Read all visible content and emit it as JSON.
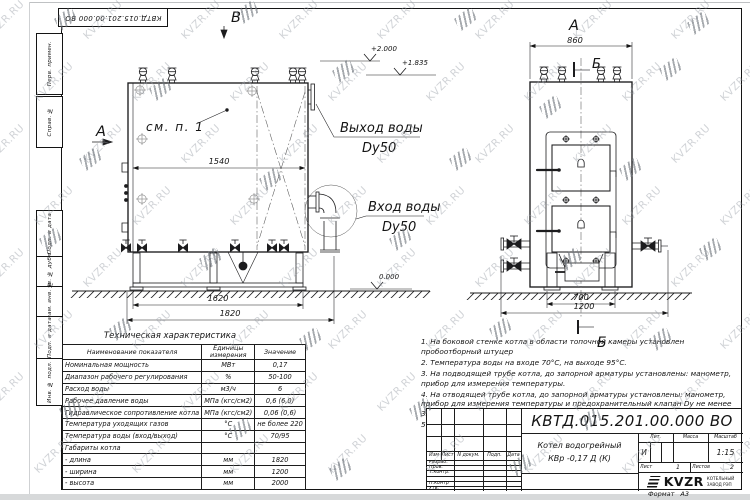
{
  "watermark": {
    "text": "KVZR.RU"
  },
  "stamp_top": {
    "text": "КВТД.015.201.00.000  ВО"
  },
  "side_column": {
    "box1": "Перв. примен.",
    "box2": "Справ. №",
    "box3": "Подп. и дата",
    "box4": "Инв. № дубл.",
    "box5": "Взам. инв. №",
    "box6": "Подп. и дата",
    "box7": "Инв. № подл."
  },
  "drawing": {
    "front": {
      "view_label": "А",
      "top_view_label": "В",
      "see_note": "см. п. 1",
      "outlet_label_1": "Выход воды",
      "outlet_label_2": "Dy50",
      "inlet_label_1": "Вход воды",
      "inlet_label_2": "Dy50",
      "elev_1": "+2.000",
      "elev_2": "+1.835",
      "elev_0": "0.000",
      "dim_width": "1540",
      "dim_base": "1620",
      "dim_total": "1820"
    },
    "side": {
      "view_label": "А",
      "section_label_top": "Б",
      "section_label_bottom": "Б",
      "dim_top": "860",
      "dim_base": "700",
      "dim_total": "1200"
    }
  },
  "spec_table": {
    "title": "Техническая характеристика",
    "col_headers": [
      "Наименование показателя",
      "Единицы измерения",
      "Значение"
    ],
    "rows": [
      [
        "Номинальная мощность",
        "МВт",
        "0,17"
      ],
      [
        "Диапазон рабочего регулирования",
        "%",
        "50-100"
      ],
      [
        "Расход воды",
        "м3/ч",
        "6"
      ],
      [
        "Рабочее давление воды",
        "МПа (кгс/см2)",
        "0,6 (6,0)"
      ],
      [
        "Гидравлическое сопротивление котла",
        "МПа (кгс/см2)",
        "0,06 (0,6)"
      ],
      [
        "Температура уходящих газов",
        "°С",
        "не более 220"
      ],
      [
        "Температура воды (вход/выход)",
        "°С",
        "70/95"
      ],
      [
        "Габариты котла",
        "",
        ""
      ],
      [
        "- длина",
        "мм",
        "1820"
      ],
      [
        "- ширина",
        "мм",
        "1200"
      ],
      [
        "- высота",
        "мм",
        "2000"
      ]
    ]
  },
  "notes": [
    "1. На боковой стенке котла в области топочной камеры установлен пробоотборный штуцер",
    "2. Температура воды на входе 70°С, на выходе 95°С.",
    "3. На подводящей трубе котла, до запорной арматуры установлены: манометр, прибор для измерения температуры.",
    "4. На отводящей трубе котла, до запорной арматуры установлены: манометр, прибор для измерения температуры и предохранительный клапан Dу не менее 32 мм.",
    "5. Остальные технические требования по ОСТ 108.030.133-84."
  ],
  "title_block": {
    "doc_number": "КВТД.015.201.00.000  ВО",
    "rev_headers": [
      "Изм",
      "Лист",
      "N докум.",
      "Подп.",
      "Дата"
    ],
    "row_labels": [
      "Разраб.",
      "Пров.",
      "Т.контр.",
      "",
      "Н.контр",
      "Утв."
    ],
    "name_line1": "Котел водогрейный",
    "name_line2": "КВр -0,17  Д  (К)",
    "lit_header": "Лит.",
    "mass_header": "Масса",
    "scale_header": "Масштаб",
    "lit_value": "И",
    "scale_value": "1:15",
    "sheet_label": "Лист",
    "sheet_value": "1",
    "sheets_label": "Листов",
    "sheets_value": "2",
    "logo_text": "KVZR",
    "company_line1": "КОТЕЛЬНЫЙ",
    "company_line2": "ЗАВОД РЭП",
    "format_label": "Формат",
    "format_value": "А3"
  }
}
